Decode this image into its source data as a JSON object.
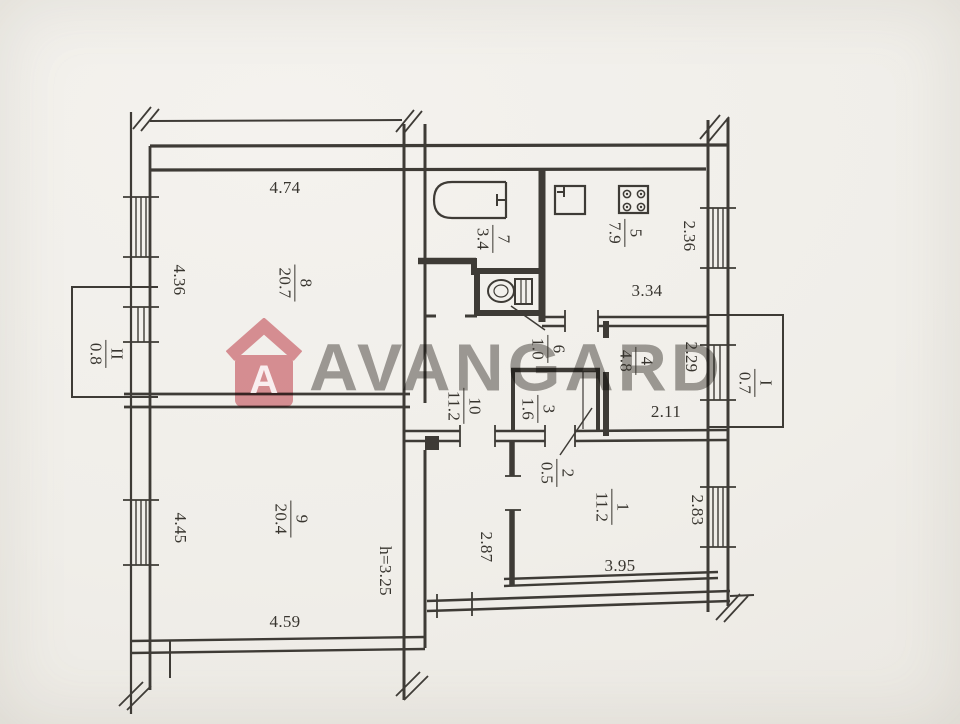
{
  "watermark": {
    "brand_text": "AVANGARD",
    "logo_letter": "A",
    "logo_color": "#cf5560",
    "text_color": "#a3a19e"
  },
  "plan": {
    "line_color": "#3e3b36",
    "paper_color": "#f0eee9",
    "height_note": {
      "text": "h=3.25"
    },
    "dims": {
      "d474": {
        "text": "4.74"
      },
      "d436": {
        "text": "4.36"
      },
      "d445": {
        "text": "4.45"
      },
      "d459": {
        "text": "4.59"
      },
      "d287": {
        "text": "2.87"
      },
      "d334": {
        "text": "3.34"
      },
      "d236": {
        "text": "2.36"
      },
      "d229": {
        "text": "2.29"
      },
      "d211": {
        "text": "2.11"
      },
      "d283": {
        "text": "2.83"
      },
      "d395": {
        "text": "3.95"
      }
    },
    "rooms": {
      "r1": {
        "num": "1",
        "area": "11.2"
      },
      "r2": {
        "num": "2",
        "area": "0.5"
      },
      "r3": {
        "num": "3",
        "area": "1.6"
      },
      "r4": {
        "num": "4",
        "area": "4.8"
      },
      "r5": {
        "num": "5",
        "area": "7.9"
      },
      "r6": {
        "num": "6",
        "area": "1.0"
      },
      "r7": {
        "num": "7",
        "area": "3.4"
      },
      "r8": {
        "num": "8",
        "area": "20.7"
      },
      "r9": {
        "num": "9",
        "area": "20.4"
      },
      "r10": {
        "num": "10",
        "area": "11.2"
      },
      "balcony1": {
        "num": "I",
        "area": "0.7"
      },
      "balcony2": {
        "num": "II",
        "area": "0.8"
      }
    }
  }
}
